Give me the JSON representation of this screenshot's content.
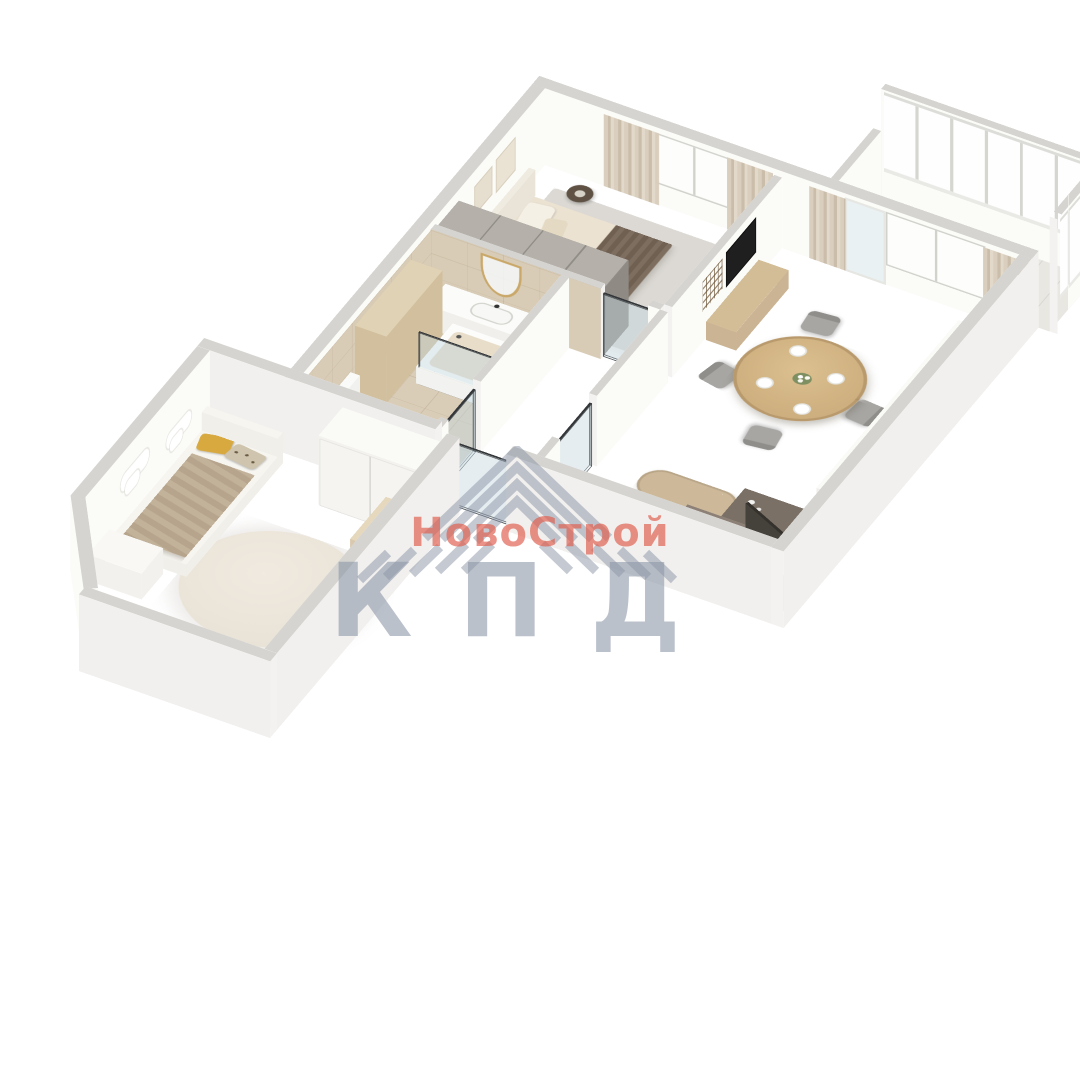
{
  "watermark": {
    "brand": "НовоСтрой",
    "abbr": "КПД",
    "brand_color": "#df5848",
    "abbr_color": "#8a94a6",
    "logo_color": "#8a94a6",
    "logo_icon": "chevron-roof-icon"
  },
  "palette": {
    "wall_top": "#d5d4d0",
    "wall_inner": "#fbfbf8",
    "wall_outer": "#f1f0ee",
    "wood_floor": "#e8dbc5",
    "tile": "#dacdb8",
    "rug_gray": "#dcd9d4",
    "bed_linen": "#ebe2d2",
    "throw_brown": "#6f6052",
    "curtain_beige": "#d3c7b4",
    "table_wood": "#cfae7f",
    "chair_gray": "#a7a6a3",
    "sofa_gray": "#cfcecb",
    "seat_brown": "#8d8177",
    "pillow_pink": "#cf9a9b",
    "kitchen_white": "#f0efec",
    "wardrobe_dark": "#8f8b84",
    "kids_blanket": "#b6a48c",
    "pillow_mustard": "#d8a93f",
    "glass_tint": "rgba(195,215,224,0.25)"
  },
  "scene": {
    "type": "3d-floorplan-render",
    "rooms": [
      "bedroom",
      "living-dining-kitchen",
      "hallway",
      "bathroom",
      "kids-room",
      "balcony"
    ]
  }
}
